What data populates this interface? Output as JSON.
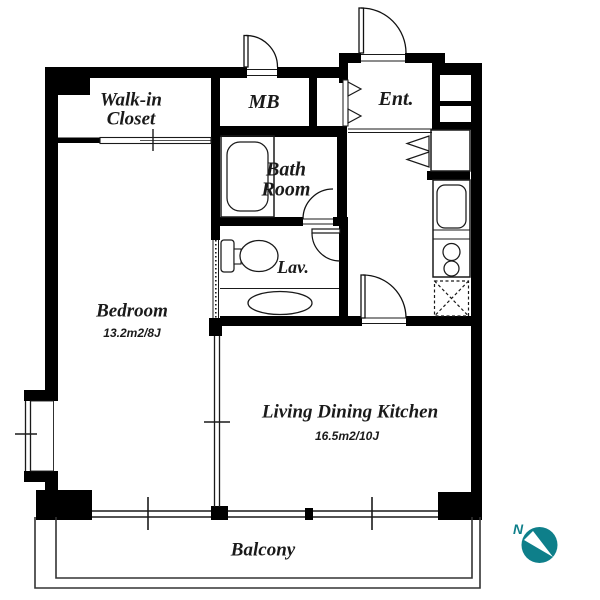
{
  "plan": {
    "rooms": {
      "walk_in_closet": {
        "label": "Walk-in\nCloset"
      },
      "meter_box": {
        "label": "MB"
      },
      "entrance": {
        "label": "Ent."
      },
      "bath_room": {
        "label": "Bath\nRoom"
      },
      "lavatory": {
        "label": "Lav."
      },
      "bedroom": {
        "label": "Bedroom",
        "area": "13.2m2/8J"
      },
      "living_dining_kitchen": {
        "label": "Living Dining Kitchen",
        "area": "16.5m2/10J"
      },
      "balcony": {
        "label": "Balcony"
      }
    },
    "compass": {
      "label": "N",
      "color": "#0e7f8a"
    },
    "colors": {
      "wall": "#000000",
      "line_and_text": "#1a1a1a"
    }
  }
}
